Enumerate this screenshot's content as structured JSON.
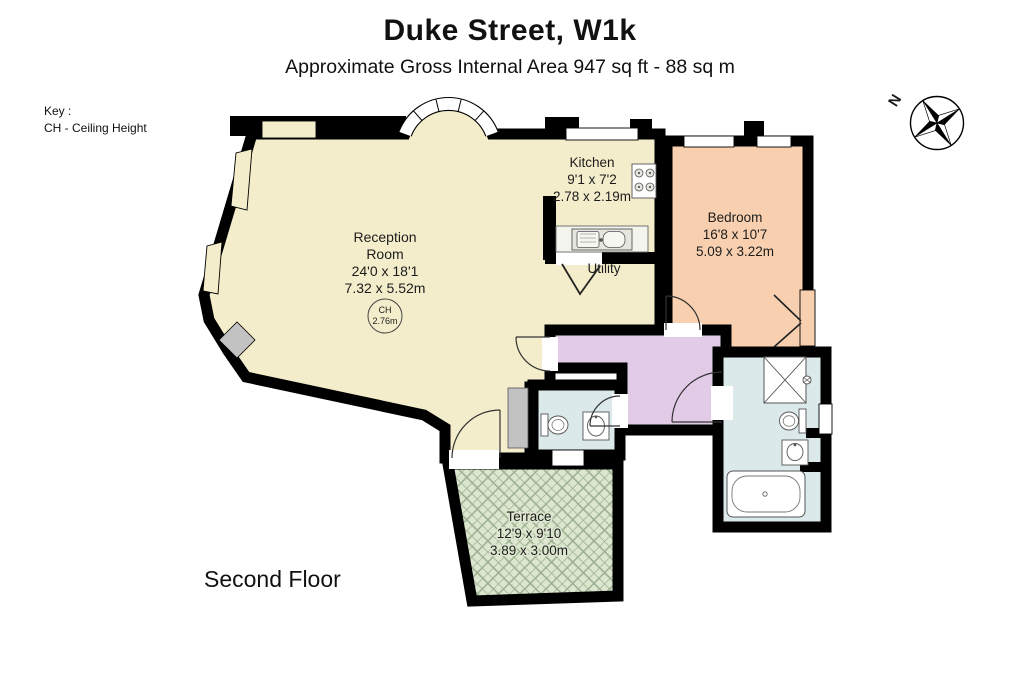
{
  "header": {
    "title": "Duke Street, W1k",
    "subtitle": "Approximate Gross Internal Area 947 sq ft - 88 sq m"
  },
  "key": {
    "heading": "Key :",
    "items": [
      {
        "label": "CH - Ceiling Height"
      }
    ]
  },
  "floor_label": "Second Floor",
  "compass": {
    "north_label": "N"
  },
  "rooms": {
    "reception": {
      "name_line1": "Reception",
      "name_line2": "Room",
      "dims_imperial": "24'0 x 18'1",
      "dims_metric": "7.32 x 5.52m",
      "ceiling_height": {
        "abbr": "CH",
        "value": "2.76m"
      }
    },
    "kitchen": {
      "name": "Kitchen",
      "dims_imperial": "9'1 x 7'2",
      "dims_metric": "2.78 x 2.19m"
    },
    "bedroom": {
      "name": "Bedroom",
      "dims_imperial": "16'8 x 10'7",
      "dims_metric": "5.09 x 3.22m"
    },
    "utility": {
      "name": "Utility"
    },
    "terrace": {
      "name": "Terrace",
      "dims_imperial": "12'9 x 9'10",
      "dims_metric": "3.89 x 3.00m"
    }
  },
  "palette": {
    "wall": "#000000",
    "reception_floor": "#F3EDCB",
    "bedroom_floor": "#F8D0B0",
    "hallway_floor": "#E2CBE7",
    "bathroom_floor": "#DCE9EB",
    "terrace_floor": "#DDE7D0",
    "terrace_hatch": "#98AD8C",
    "fixture_gray": "#C2C2C2",
    "window_white": "#FFFFFF"
  },
  "icons": {
    "compass": "compass-rose-icon",
    "shower": "shower-icon",
    "bathtub": "bathtub-icon",
    "toilet": "toilet-icon",
    "basin": "basin-icon",
    "kitchen_sink": "kitchen-sink-icon",
    "hob": "hob-icon",
    "fireplace": "fireplace-icon"
  }
}
